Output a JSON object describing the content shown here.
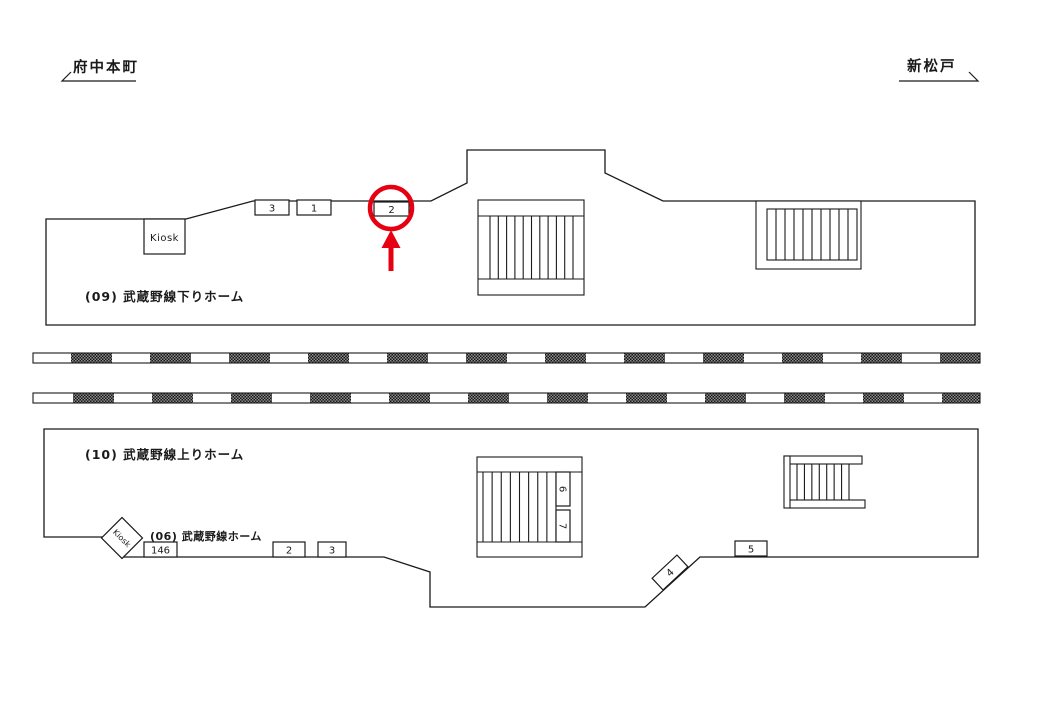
{
  "directions": {
    "left": {
      "label": "府中本町"
    },
    "right": {
      "label": "新松戸"
    }
  },
  "platform_top": {
    "label": "(09) 武蔵野線下りホーム",
    "kiosk": "Kiosk",
    "ad_positions": {
      "p3": "3",
      "p1": "1",
      "p2": "2"
    }
  },
  "platform_bottom": {
    "label": "(10) 武蔵野線上りホーム",
    "line_label": "(06) 武蔵野線ホーム",
    "kiosk": "Kiosk",
    "ad_positions": {
      "p146": "146",
      "p2": "2",
      "p3": "3",
      "p4": "4",
      "p5": "5",
      "p6": "6",
      "p7": "7"
    }
  },
  "annotation": {
    "highlighted_position": "2",
    "color": "#e60012"
  }
}
